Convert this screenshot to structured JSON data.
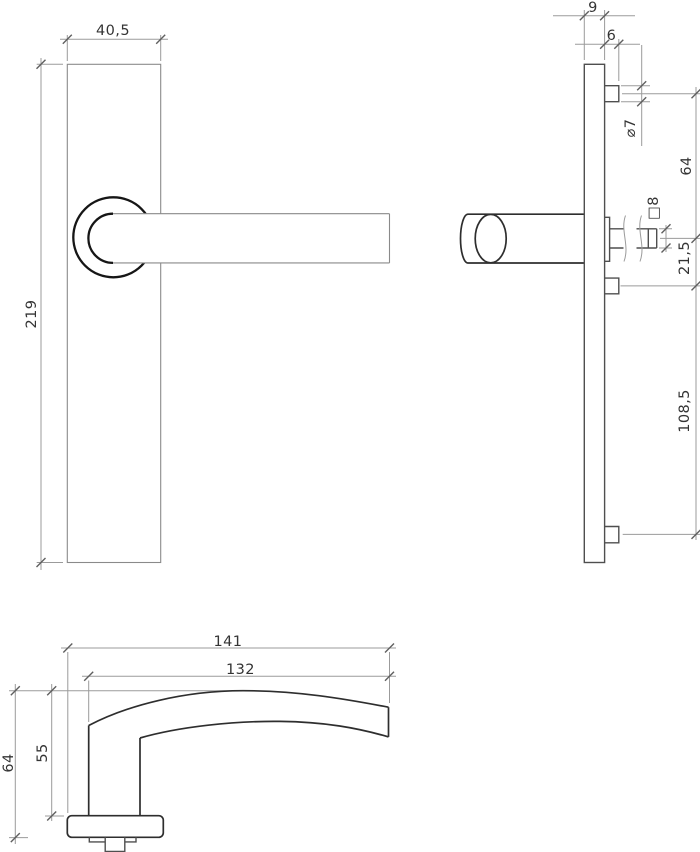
{
  "drawing": {
    "background": "#ffffff",
    "object_line_color": "#2e2e2e",
    "dimension_line_color": "#9b9b9b",
    "text_color": "#343434",
    "front": {
      "plate_width": "40,5",
      "plate_height": "219"
    },
    "side": {
      "plate_thickness": "9",
      "boss_height": "6",
      "screw_diameter": "⌀7",
      "screw_to_spindle": "64",
      "spindle_square": "□8",
      "spindle_to_screw": "21,5",
      "screw_spacing": "108,5"
    },
    "bottom": {
      "overall_length": "141",
      "grip_length": "132",
      "overall_depth": "64",
      "grip_depth": "55"
    }
  }
}
